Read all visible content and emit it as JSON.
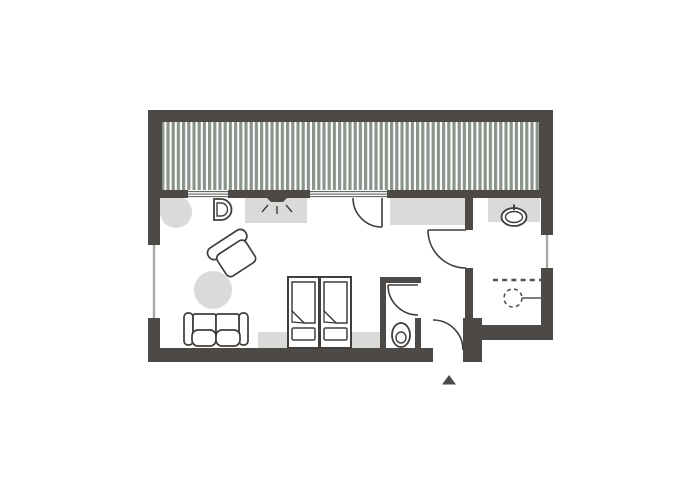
{
  "app": {
    "type": "floor-plan",
    "description": "architectural floor plan of a studio apartment with terrace deck, living/bedroom, kitchenette, WC, bathroom and entry"
  },
  "colors": {
    "background": "#ffffff",
    "wall": "#4d4946",
    "hatch_stripe": "#8b948c",
    "fixture_gray": "#dadad8",
    "outline": "#403d3a",
    "window_line": "#a6aaa4",
    "glazing_line": "#55534f",
    "dashed_mark": "#55524e"
  },
  "plan": {
    "rooms": [
      {
        "id": "terrace-deck"
      },
      {
        "id": "living-bedroom"
      },
      {
        "id": "wc"
      },
      {
        "id": "bathroom"
      },
      {
        "id": "entry-hall"
      }
    ],
    "furniture": [
      {
        "id": "kitchen-corner-counter"
      },
      {
        "id": "kitchen-sink"
      },
      {
        "id": "cooktop-lamp-symbol"
      },
      {
        "id": "kitchen-counter"
      },
      {
        "id": "armchair"
      },
      {
        "id": "round-rug"
      },
      {
        "id": "sofa"
      },
      {
        "id": "double-bed"
      },
      {
        "id": "bed-rug"
      },
      {
        "id": "wardrobe-counter"
      },
      {
        "id": "toilet"
      },
      {
        "id": "washbasin"
      },
      {
        "id": "bathroom-counter"
      },
      {
        "id": "shower-symbol"
      },
      {
        "id": "entrance-marker"
      }
    ],
    "window_count": 4,
    "door_count": 4
  }
}
